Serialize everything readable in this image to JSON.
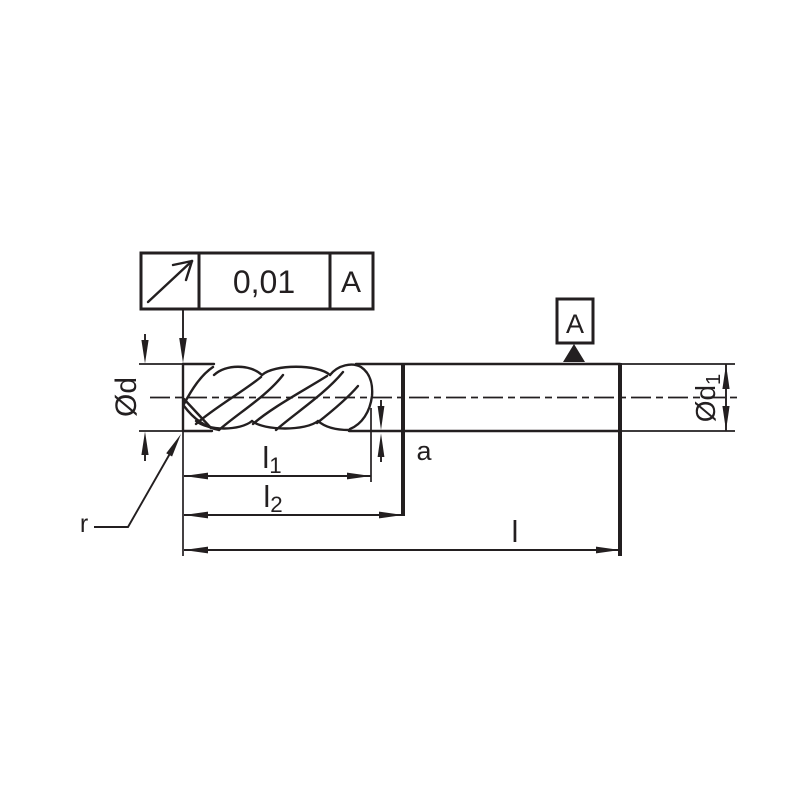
{
  "feature_control_frame": {
    "symbol_icon": "circular-runout-arrow-icon",
    "tolerance_value": "0,01",
    "datum_reference": "A"
  },
  "datum_flag": {
    "label": "A"
  },
  "dimension_labels": {
    "cut_diameter": {
      "base": "Ød"
    },
    "shank_diameter": {
      "base": "Ød",
      "sub": "1"
    },
    "flute_length": {
      "base": "l",
      "sub": "1"
    },
    "usable_length": {
      "base": "l",
      "sub": "2"
    },
    "overall_length": {
      "base": "l"
    },
    "step": {
      "base": "a"
    },
    "corner_radius": {
      "base": "r"
    }
  },
  "colors": {
    "ink": "#231f20",
    "background": "#ffffff"
  }
}
